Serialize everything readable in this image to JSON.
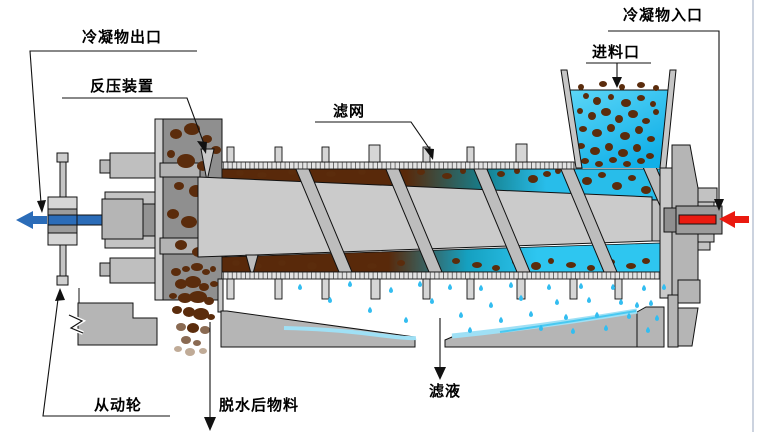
{
  "diagram": {
    "type": "screw-press-dewatering-machine-schematic",
    "labels": {
      "condensate_outlet": "冷凝物出口",
      "back_pressure_device": "反压装置",
      "filter_screen": "滤网",
      "feed_inlet": "进料口",
      "condensate_inlet": "冷凝物入口",
      "driven_wheel": "从动轮",
      "dewatered_material": "脱水后物料",
      "filtrate": "滤液"
    },
    "colors": {
      "machine_gray": "#c9c9c9",
      "housing_gray": "#8f8f8f",
      "screen_gray": "#e3e3e3",
      "material_brown": "#59290a",
      "water_cyan": "#28bdea",
      "filtrate_film_cyan": "#9fe0f5",
      "outlet_arrow_blue": "#2b6cb8",
      "inlet_arrow_red": "#ea1a10",
      "outline_black": "#000000"
    }
  }
}
